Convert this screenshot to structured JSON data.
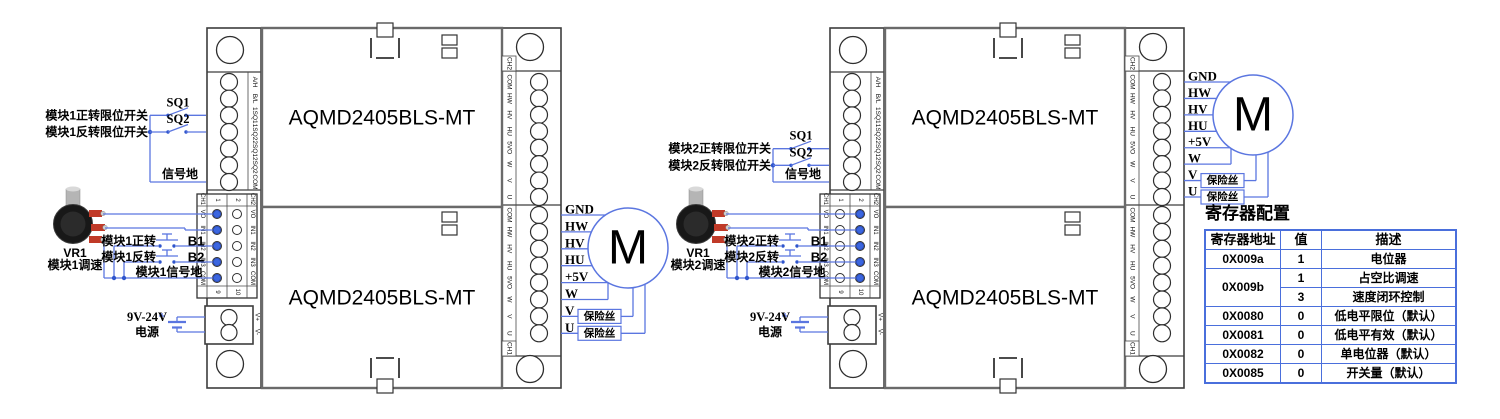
{
  "diagram": {
    "module_title": "AQMD2405BLS-MT",
    "left_strip_labels": [
      "A/H",
      "B/L",
      "1SQ1",
      "1SQ2",
      "2SQ1",
      "2SQ2",
      "COM"
    ],
    "right_strip_labels": [
      "COM",
      "HW",
      "HV",
      "HU",
      "5VO",
      "W",
      "V",
      "U"
    ],
    "right_strip_ch_top": "CH2",
    "right_strip_ch_bottom": "CH1",
    "mid_block": {
      "ch1": "CH1",
      "ch2": "CH2",
      "row_labels": [
        "VO",
        "IN1",
        "IN2",
        "IN3",
        "COM"
      ],
      "top_numbers": [
        "1",
        "2"
      ],
      "bottom_numbers": [
        "9",
        "10"
      ]
    },
    "power_labels": [
      "V+",
      "V-"
    ],
    "motor_label": "M",
    "motor_pin_labels": [
      "GND",
      "HW",
      "HV",
      "HU",
      "+5V",
      "W",
      "V",
      "U"
    ],
    "fuse_label": "保险丝"
  },
  "assembly1": {
    "fwd_limit_label": "模块1正转限位开关",
    "rev_limit_label": "模块1反转限位开关",
    "sq1": "SQ1",
    "sq2": "SQ2",
    "signal_gnd": "信号地",
    "pot_ref": "VR1",
    "pot_label": "模块1调速",
    "fwd_label": "模块1正转",
    "rev_label": "模块1反转",
    "b1": "B1",
    "b2": "B2",
    "sig_gnd_label": "模块1信号地",
    "psu_v": "9V-24V",
    "psu_label": "电源"
  },
  "assembly2": {
    "fwd_limit_label": "模块2正转限位开关",
    "rev_limit_label": "模块2反转限位开关",
    "sq1": "SQ1",
    "sq2": "SQ2",
    "signal_gnd": "信号地",
    "pot_ref": "VR1",
    "pot_label": "模块2调速",
    "fwd_label": "模块2正转",
    "rev_label": "模块2反转",
    "b1": "B1",
    "b2": "B2",
    "sig_gnd_label": "模块2信号地",
    "psu_v": "9V-24V",
    "psu_label": "电源"
  },
  "register_table": {
    "title": "寄存器配置",
    "headers": [
      "寄存器地址",
      "值",
      "描述"
    ],
    "rows": [
      {
        "addr": "0X009a",
        "cells": [
          {
            "value": "1",
            "desc": "电位器"
          }
        ]
      },
      {
        "addr": "0X009b",
        "cells": [
          {
            "value": "1",
            "desc": "占空比调速"
          },
          {
            "value": "3",
            "desc": "速度闭环控制"
          }
        ]
      },
      {
        "addr": "0X0080",
        "cells": [
          {
            "value": "0",
            "desc": "低电平限位（默认）"
          }
        ]
      },
      {
        "addr": "0X0081",
        "cells": [
          {
            "value": "0",
            "desc": "低电平有效（默认）"
          }
        ]
      },
      {
        "addr": "0X0082",
        "cells": [
          {
            "value": "0",
            "desc": "单电位器（默认）"
          }
        ]
      },
      {
        "addr": "0X0085",
        "cells": [
          {
            "value": "0",
            "desc": "开关量（默认）"
          }
        ]
      }
    ]
  },
  "colors": {
    "wire_blue": "#5b76e0",
    "table_border_blue": "#4a6fdc",
    "connection_dot_blue": "#3b66e0",
    "pot_terminal_red": "#c03a28"
  }
}
